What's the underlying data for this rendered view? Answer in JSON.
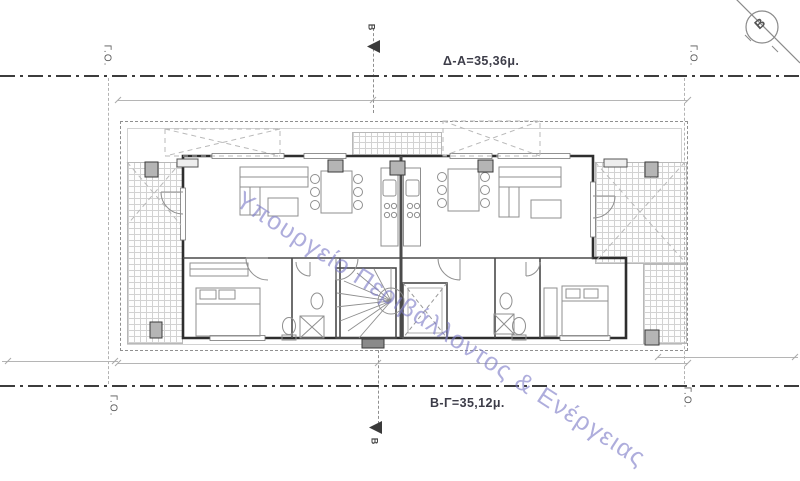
{
  "sheet": {
    "watermark_text": "Υπουργείο Περιβάλλοντος & Ενέργειας",
    "labels": {
      "building_line": "Γ.Ο.",
      "top_length": "Δ-Α=35,36μ.",
      "bottom_length": "Β-Γ=35,12μ.",
      "section_mark": "B"
    },
    "colors": {
      "watermark": "#7d7ac7",
      "wall": "#2e2e2e",
      "partition": "#4a4a4a",
      "furniture": "#8f8f8f",
      "hatch": "#d2d2d2",
      "column_fill": "#b5b5b5",
      "dashdot": "#3c3c3c"
    }
  }
}
